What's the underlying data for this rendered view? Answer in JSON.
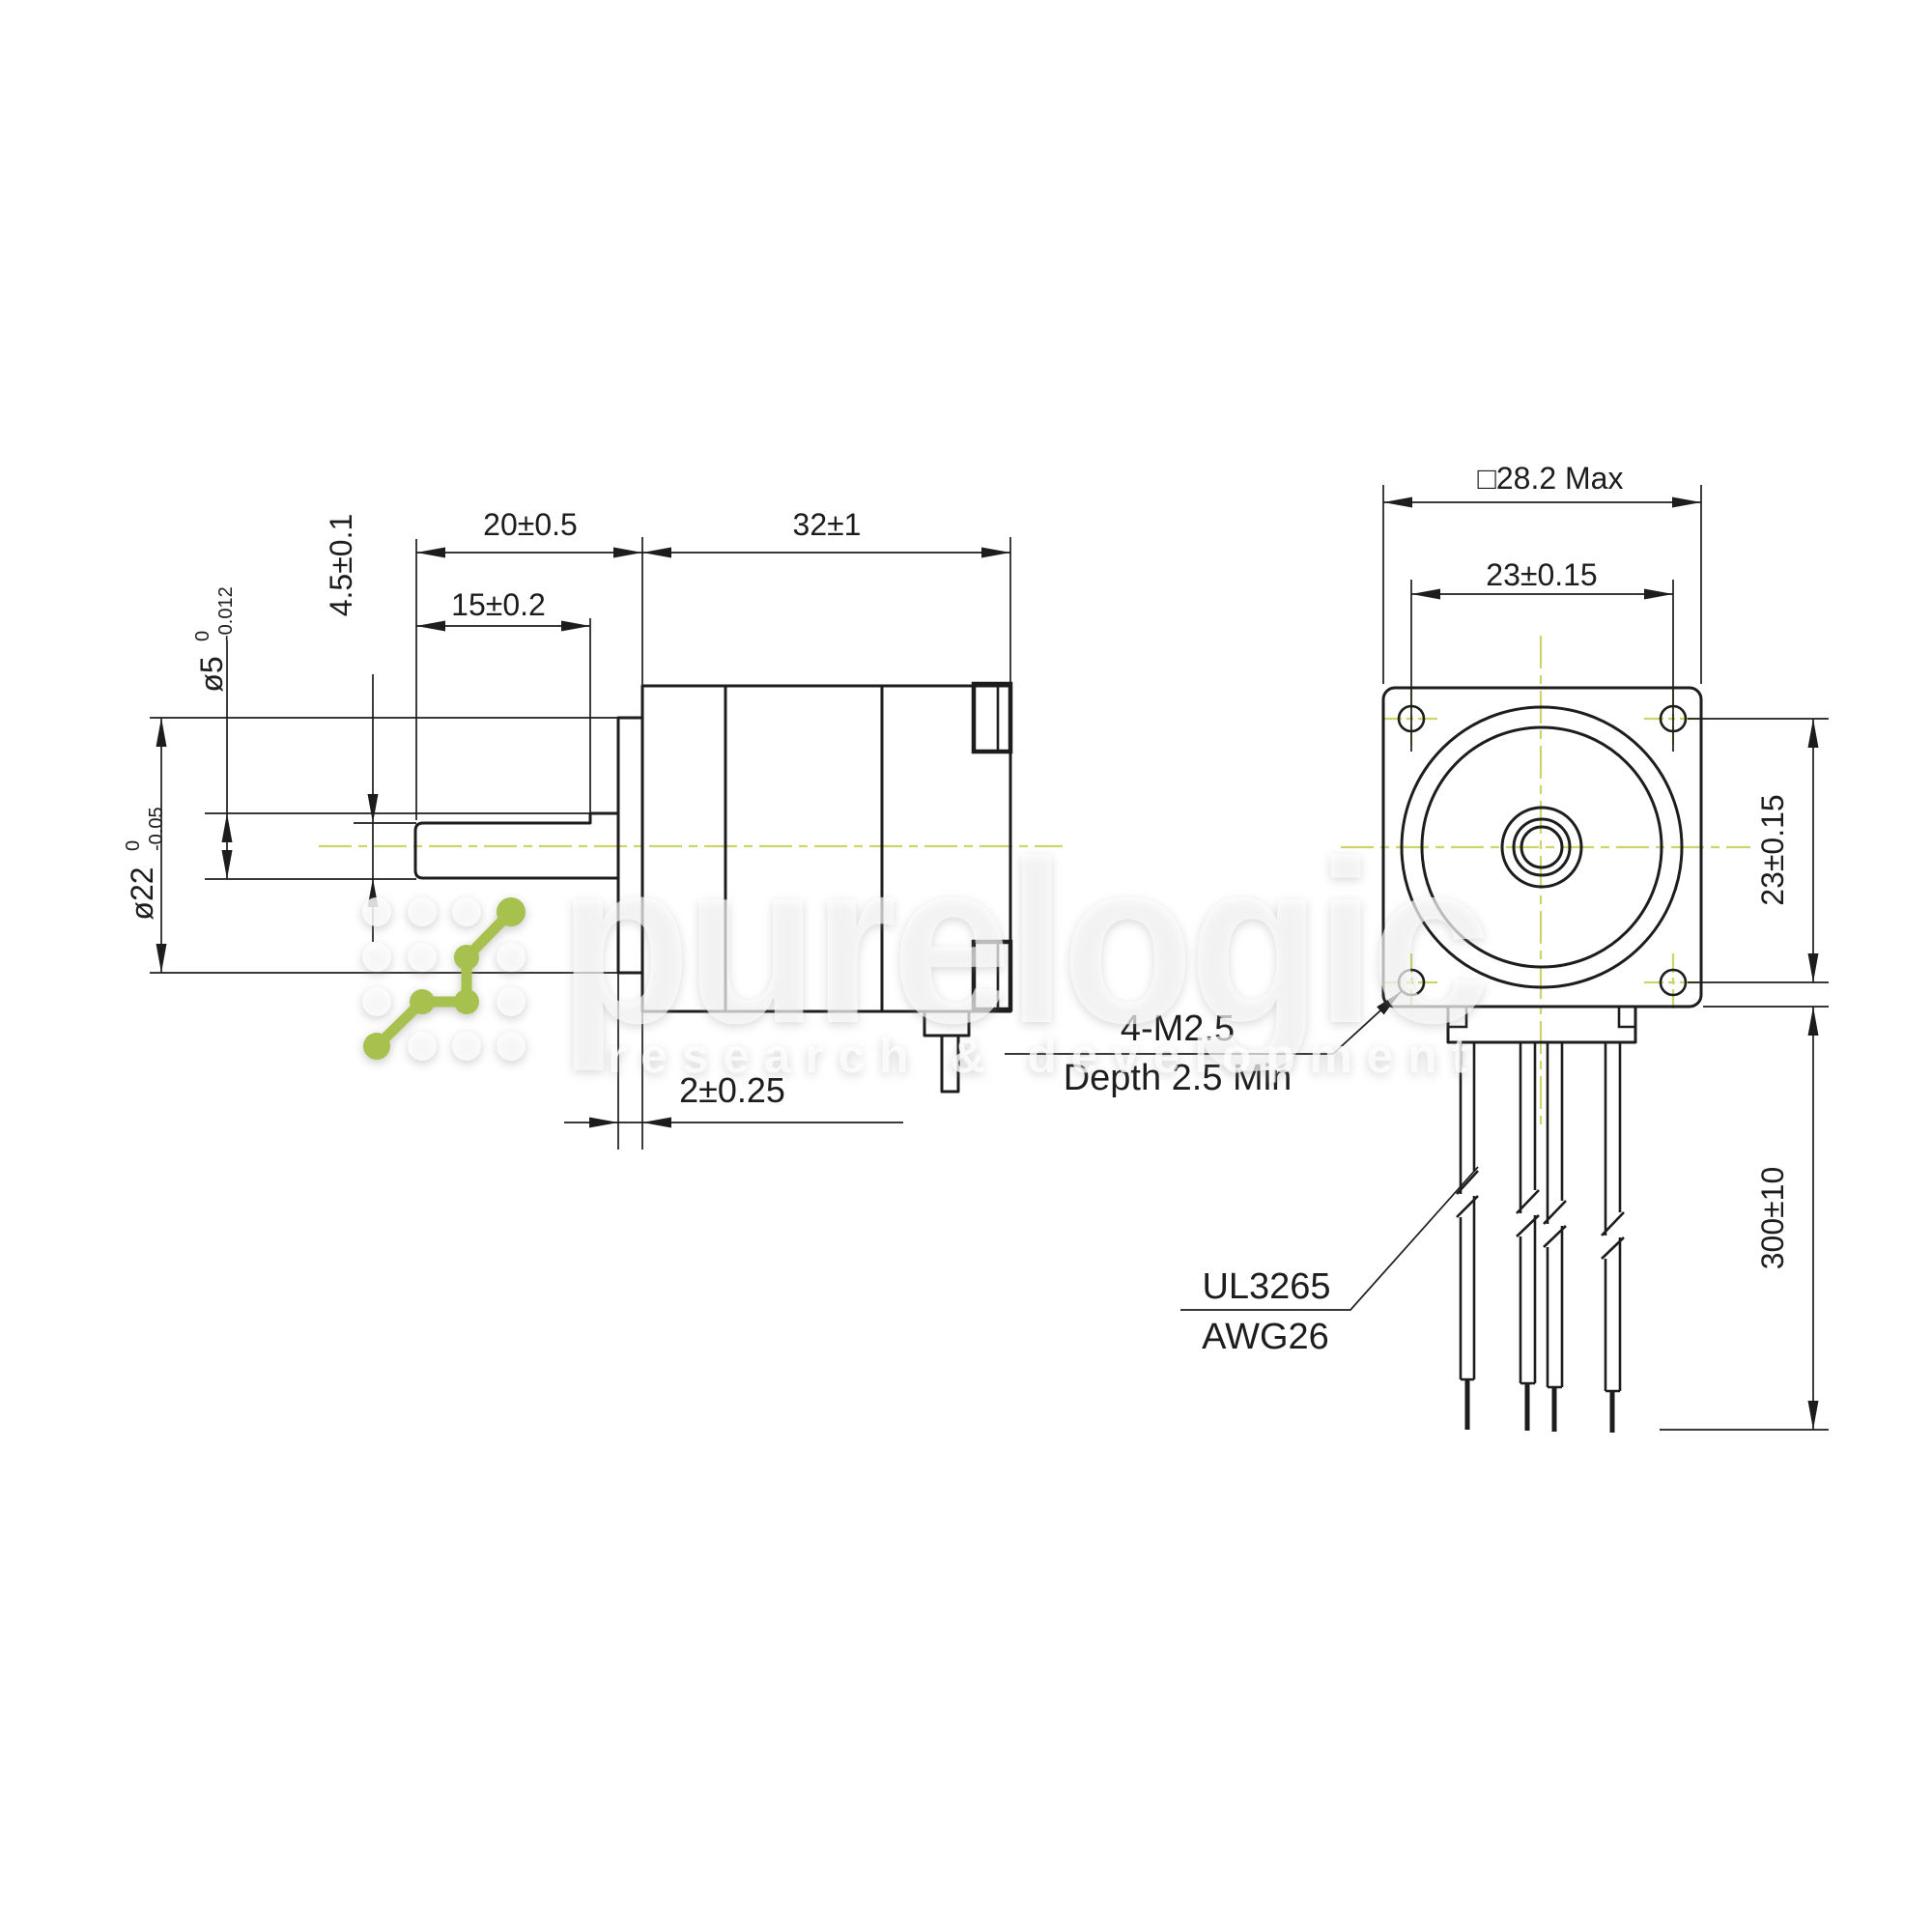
{
  "colors": {
    "line": "#1d1d1d",
    "centerline": "#ccd46a",
    "logo_green": "#a7c14f"
  },
  "side_view": {
    "dim_shaft_length": "20±0.5",
    "dim_body_length": "32±1",
    "dim_flat_length": "15±0.2",
    "dim_flat_height": "4.5±0.1",
    "dim_boss_depth": "2±0.25",
    "dia_shaft": {
      "main": "ø5",
      "sup": "0",
      "sub": "-0.012"
    },
    "dia_boss": {
      "main": "ø22",
      "sup": "0",
      "sub": "-0.05"
    }
  },
  "front_view": {
    "dim_square_max": "□28.2 Max",
    "dim_hole_spacing_h": "23±0.15",
    "dim_hole_spacing_v": "23±0.15",
    "dim_wire_length": "300±10",
    "note_mount_line1": "4-M2.5",
    "note_mount_line2": "Depth 2.5 Min",
    "note_wire_line1": "UL3265",
    "note_wire_line2": "AWG26"
  },
  "watermark": {
    "brand": "purelogic",
    "tagline": "research & development"
  }
}
